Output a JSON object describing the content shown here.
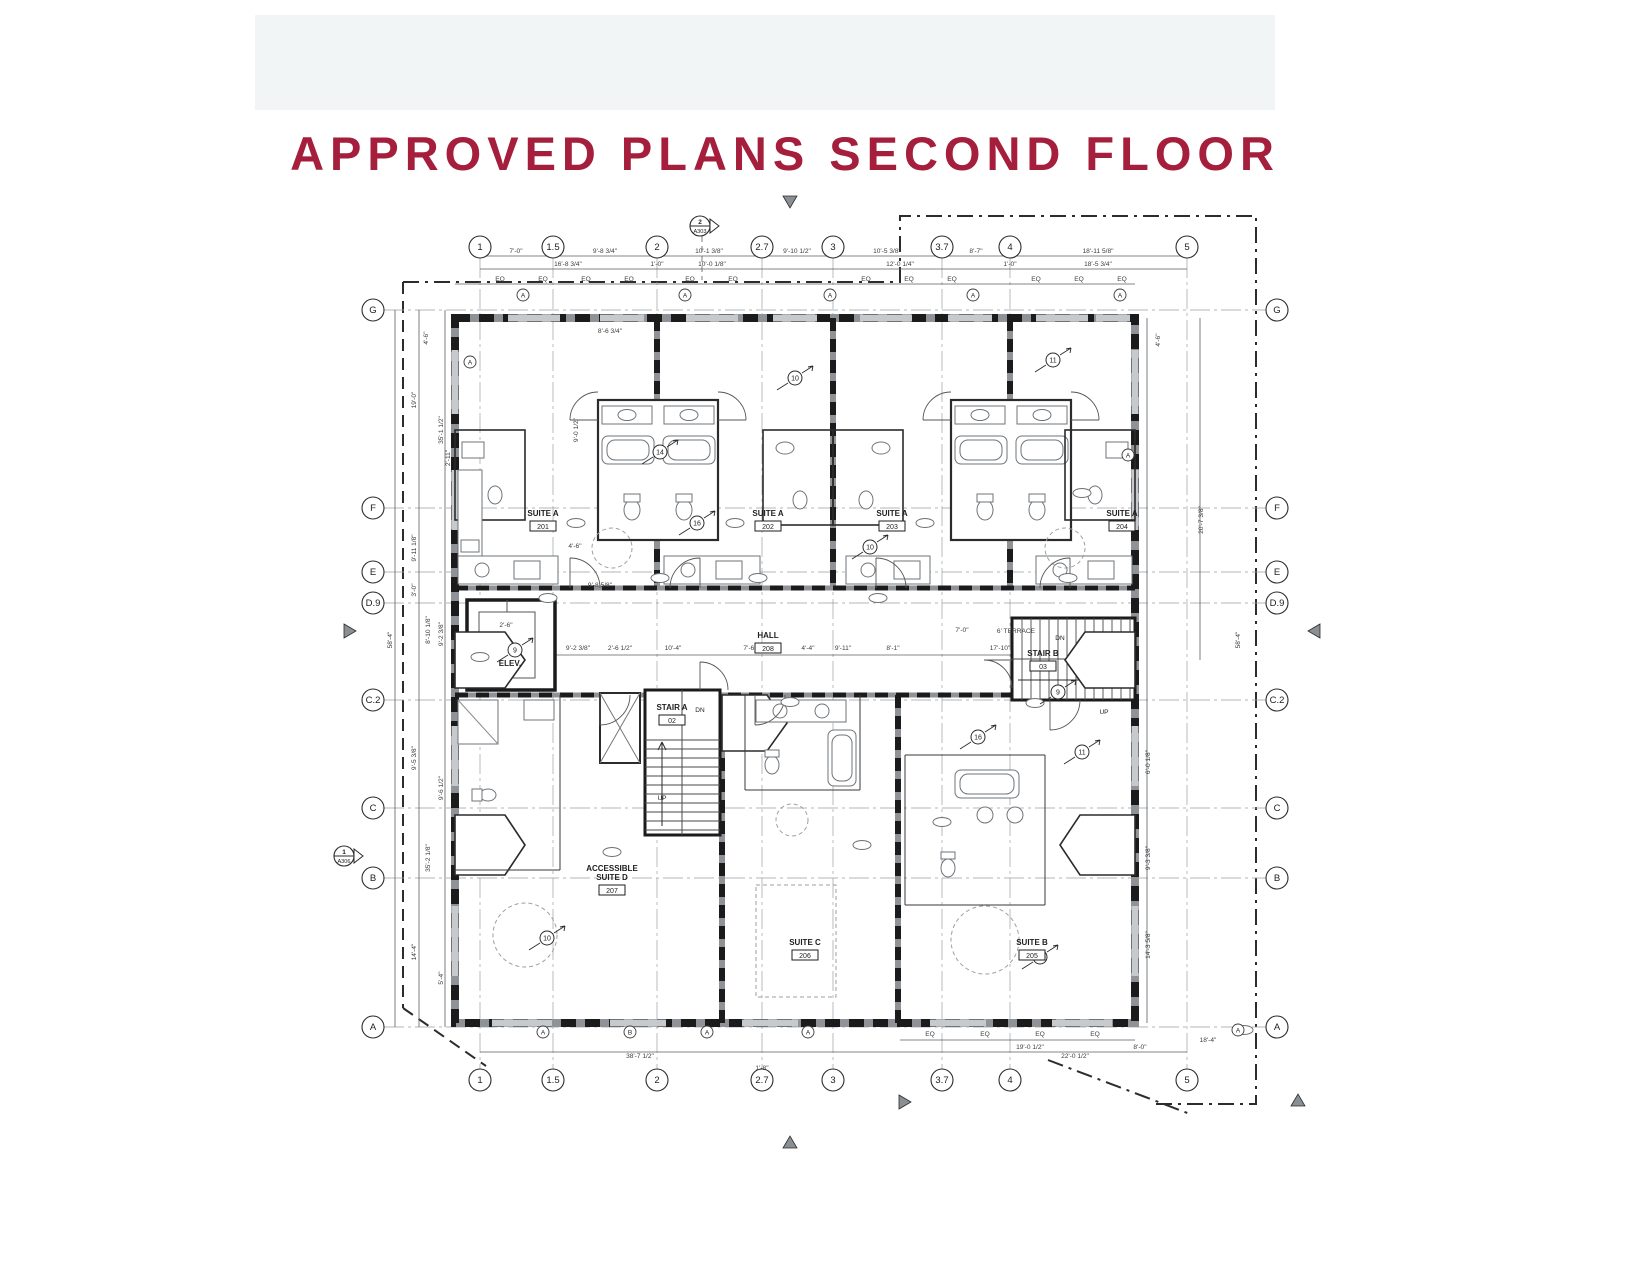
{
  "title": "APPROVED PLANS SECOND FLOOR",
  "colors": {
    "accent": "#a51e3c",
    "band": "#f2f5f6",
    "wall_dark": "#1b1b1b",
    "wall_gray": "#8f9296",
    "line": "#3a3a3a",
    "dim_text": "#3d3d3d"
  },
  "plan": {
    "grid": {
      "top_y": 247,
      "bottom_y": 1080,
      "left_x": 373,
      "right_x": 1277,
      "columns": [
        {
          "label": "1",
          "x": 480
        },
        {
          "label": "1.5",
          "x": 553
        },
        {
          "label": "2",
          "x": 657
        },
        {
          "label": "2.7",
          "x": 762
        },
        {
          "label": "3",
          "x": 833
        },
        {
          "label": "3.7",
          "x": 942
        },
        {
          "label": "4",
          "x": 1010
        },
        {
          "label": "5",
          "x": 1187
        }
      ],
      "rows": [
        {
          "label": "G",
          "y": 310
        },
        {
          "label": "F",
          "y": 508
        },
        {
          "label": "E",
          "y": 572
        },
        {
          "label": "D.9",
          "y": 603
        },
        {
          "label": "C.2",
          "y": 700
        },
        {
          "label": "C",
          "y": 808
        },
        {
          "label": "B",
          "y": 878
        },
        {
          "label": "A",
          "y": 1027
        }
      ]
    },
    "rooms": [
      {
        "name": "SUITE A",
        "number": "201",
        "x": 543,
        "y": 516
      },
      {
        "name": "SUITE A",
        "number": "202",
        "x": 768,
        "y": 516
      },
      {
        "name": "SUITE A",
        "number": "203",
        "x": 892,
        "y": 516
      },
      {
        "name": "SUITE A",
        "number": "204",
        "x": 1122,
        "y": 516
      },
      {
        "name": "HALL",
        "number": "208",
        "x": 768,
        "y": 638
      },
      {
        "name": "STAIR A",
        "number": "02",
        "x": 672,
        "y": 710
      },
      {
        "name": "STAIR B",
        "number": "03",
        "x": 1043,
        "y": 656
      },
      {
        "name": "ELEV.",
        "number": "",
        "x": 510,
        "y": 666
      },
      {
        "name": "ACCESSIBLE\nSUITE D",
        "number": "207",
        "x": 612,
        "y": 871
      },
      {
        "name": "SUITE C",
        "number": "206",
        "x": 805,
        "y": 945
      },
      {
        "name": "SUITE B",
        "number": "205",
        "x": 1032,
        "y": 945
      }
    ],
    "dimensions": [
      {
        "t": "7'-0\"",
        "x": 516,
        "y": 253
      },
      {
        "t": "9'-8 3/4\"",
        "x": 605,
        "y": 253
      },
      {
        "t": "10'-1 3/8\"",
        "x": 709,
        "y": 253
      },
      {
        "t": "9'-10 1/2\"",
        "x": 797,
        "y": 253
      },
      {
        "t": "10'-5 3/8\"",
        "x": 887,
        "y": 253
      },
      {
        "t": "8'-7\"",
        "x": 976,
        "y": 253
      },
      {
        "t": "18'-11 5/8\"",
        "x": 1098,
        "y": 253
      },
      {
        "t": "16'-8 3/4\"",
        "x": 568,
        "y": 266
      },
      {
        "t": "1'-0\"",
        "x": 657,
        "y": 266
      },
      {
        "t": "10'-0 1/8\"",
        "x": 712,
        "y": 266
      },
      {
        "t": "12'-0 1/4\"",
        "x": 900,
        "y": 266
      },
      {
        "t": "1'-0\"",
        "x": 1010,
        "y": 266
      },
      {
        "t": "18'-5 3/4\"",
        "x": 1098,
        "y": 266
      },
      {
        "t": "EQ",
        "x": 500,
        "y": 281
      },
      {
        "t": "EQ",
        "x": 543,
        "y": 281
      },
      {
        "t": "EQ",
        "x": 586,
        "y": 281
      },
      {
        "t": "EQ",
        "x": 629,
        "y": 281
      },
      {
        "t": "EQ",
        "x": 690,
        "y": 281
      },
      {
        "t": "EQ",
        "x": 733,
        "y": 281
      },
      {
        "t": "EQ",
        "x": 866,
        "y": 281
      },
      {
        "t": "EQ",
        "x": 909,
        "y": 281
      },
      {
        "t": "EQ",
        "x": 952,
        "y": 281
      },
      {
        "t": "EQ",
        "x": 1036,
        "y": 281
      },
      {
        "t": "EQ",
        "x": 1079,
        "y": 281
      },
      {
        "t": "EQ",
        "x": 1122,
        "y": 281
      },
      {
        "t": "8'-6 3/4\"",
        "x": 610,
        "y": 333
      },
      {
        "t": "9'-0 1/2\"",
        "x": 578,
        "y": 430,
        "r": 90
      },
      {
        "t": "4'-6\"",
        "x": 428,
        "y": 338,
        "r": 90
      },
      {
        "t": "4'-6\"",
        "x": 1160,
        "y": 340,
        "r": 90
      },
      {
        "t": "4'-6\"",
        "x": 575,
        "y": 548
      },
      {
        "t": "2'-6\"",
        "x": 506,
        "y": 627
      },
      {
        "t": "9'-8 5/8\"",
        "x": 600,
        "y": 587
      },
      {
        "t": "9'-2 3/8\"",
        "x": 578,
        "y": 650
      },
      {
        "t": "2'-6 1/2\"",
        "x": 620,
        "y": 650
      },
      {
        "t": "10'-4\"",
        "x": 673,
        "y": 650
      },
      {
        "t": "7'-6\"",
        "x": 750,
        "y": 650
      },
      {
        "t": "4'-4\"",
        "x": 808,
        "y": 650
      },
      {
        "t": "9'-11\"",
        "x": 843,
        "y": 650
      },
      {
        "t": "8'-1\"",
        "x": 893,
        "y": 650
      },
      {
        "t": "17'-10\"",
        "x": 1000,
        "y": 650
      },
      {
        "t": "7'-0\"",
        "x": 962,
        "y": 632
      },
      {
        "t": "6' TERRACE",
        "x": 1016,
        "y": 633
      },
      {
        "t": "19'-0\"",
        "x": 416,
        "y": 400,
        "r": 90
      },
      {
        "t": "35'-1 1/2\"",
        "x": 443,
        "y": 430,
        "r": 90
      },
      {
        "t": "2'-11\"",
        "x": 450,
        "y": 458,
        "r": 90
      },
      {
        "t": "9'-11 1/8\"",
        "x": 416,
        "y": 548,
        "r": 90
      },
      {
        "t": "3'-0\"",
        "x": 416,
        "y": 590,
        "r": 90
      },
      {
        "t": "8'-10 1/8\"",
        "x": 430,
        "y": 630,
        "r": 90
      },
      {
        "t": "9'-2 3/8\"",
        "x": 443,
        "y": 634,
        "r": 90
      },
      {
        "t": "58'-4\"",
        "x": 392,
        "y": 640,
        "r": 90
      },
      {
        "t": "9'-5 3/8\"",
        "x": 416,
        "y": 758,
        "r": 90
      },
      {
        "t": "9'-6 1/2\"",
        "x": 443,
        "y": 788,
        "r": 90
      },
      {
        "t": "35'-2 1/8\"",
        "x": 430,
        "y": 858,
        "r": 90
      },
      {
        "t": "14'-4\"",
        "x": 416,
        "y": 952,
        "r": 90
      },
      {
        "t": "5'-4\"",
        "x": 443,
        "y": 978,
        "r": 90
      },
      {
        "t": "20'-7 3/8\"",
        "x": 1203,
        "y": 520,
        "r": 90
      },
      {
        "t": "58'-4\"",
        "x": 1240,
        "y": 640,
        "r": 90
      },
      {
        "t": "6'-0 1/8\"",
        "x": 1150,
        "y": 762,
        "r": 90
      },
      {
        "t": "9'-3 3/8\"",
        "x": 1150,
        "y": 858,
        "r": 90
      },
      {
        "t": "14'-3 5/8\"",
        "x": 1150,
        "y": 945,
        "r": 90
      },
      {
        "t": "38'-7 1/2\"",
        "x": 640,
        "y": 1058
      },
      {
        "t": "1'-8\"",
        "x": 762,
        "y": 1070
      },
      {
        "t": "EQ",
        "x": 930,
        "y": 1036
      },
      {
        "t": "EQ",
        "x": 985,
        "y": 1036
      },
      {
        "t": "EQ",
        "x": 1040,
        "y": 1036
      },
      {
        "t": "EQ",
        "x": 1095,
        "y": 1036
      },
      {
        "t": "19'-0 1/2\"",
        "x": 1030,
        "y": 1049
      },
      {
        "t": "8'-0\"",
        "x": 1140,
        "y": 1049
      },
      {
        "t": "22'-0 1/2\"",
        "x": 1075,
        "y": 1058
      },
      {
        "t": "18'-4\"",
        "x": 1208,
        "y": 1042
      }
    ],
    "wall_tags": [
      {
        "t": "A",
        "x": 523,
        "y": 295
      },
      {
        "t": "A",
        "x": 685,
        "y": 295
      },
      {
        "t": "A",
        "x": 830,
        "y": 295
      },
      {
        "t": "A",
        "x": 973,
        "y": 295
      },
      {
        "t": "A",
        "x": 1120,
        "y": 295
      },
      {
        "t": "A",
        "x": 470,
        "y": 362
      },
      {
        "t": "A",
        "x": 1128,
        "y": 455
      },
      {
        "t": "A",
        "x": 543,
        "y": 1032
      },
      {
        "t": "B",
        "x": 630,
        "y": 1032
      },
      {
        "t": "A",
        "x": 707,
        "y": 1032
      },
      {
        "t": "A",
        "x": 808,
        "y": 1032
      },
      {
        "t": "A",
        "x": 1238,
        "y": 1030
      }
    ],
    "keynotes": [
      {
        "t": "10",
        "x": 795,
        "y": 378
      },
      {
        "t": "11",
        "x": 1053,
        "y": 360
      },
      {
        "t": "14",
        "x": 660,
        "y": 452
      },
      {
        "t": "16",
        "x": 697,
        "y": 523
      },
      {
        "t": "10",
        "x": 870,
        "y": 547
      },
      {
        "t": "9",
        "x": 515,
        "y": 650
      },
      {
        "t": "9",
        "x": 1058,
        "y": 692
      },
      {
        "t": "16",
        "x": 978,
        "y": 737
      },
      {
        "t": "10",
        "x": 547,
        "y": 938
      },
      {
        "t": "13",
        "x": 1040,
        "y": 957
      },
      {
        "t": "11",
        "x": 1082,
        "y": 752
      }
    ],
    "stair_texts": [
      {
        "t": "UP",
        "x": 662,
        "y": 800
      },
      {
        "t": "DN",
        "x": 700,
        "y": 712
      },
      {
        "t": "DN",
        "x": 1060,
        "y": 640
      },
      {
        "t": "UP",
        "x": 1104,
        "y": 714
      }
    ],
    "section_markers": [
      {
        "num": "2",
        "sheet": "A303",
        "x": 700,
        "y": 226,
        "dir": "right"
      },
      {
        "num": "1",
        "sheet": "A306",
        "x": 344,
        "y": 856,
        "dir": "right"
      }
    ],
    "arrows": [
      {
        "x": 790,
        "y": 204,
        "dir": "down"
      },
      {
        "x": 790,
        "y": 1140,
        "dir": "up"
      },
      {
        "x": 907,
        "y": 1102,
        "dir": "right"
      },
      {
        "x": 1298,
        "y": 1098,
        "dir": "up"
      },
      {
        "x": 1312,
        "y": 631,
        "dir": "left"
      },
      {
        "x": 352,
        "y": 631,
        "dir": "right"
      }
    ]
  }
}
